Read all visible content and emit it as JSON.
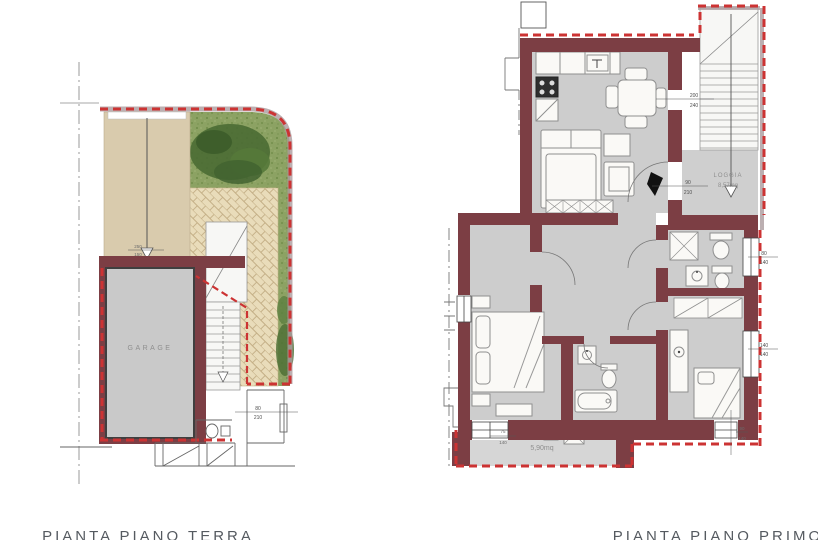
{
  "colors": {
    "wall": "#7c3e44",
    "boundary_red": "#cc3333",
    "boundary_band": "#ab9b9d",
    "floor_gray": "#cdcdcd",
    "driveway_tan": "#d9cbad",
    "grass_green": "#8ca263",
    "brick_tan": "#e9dcba",
    "title_gray": "#555a60"
  },
  "ground_floor": {
    "title": "PIANTA PIANO TERRA",
    "garage_label": "GARAGE",
    "ramp_dim_top": "250",
    "ramp_dim_bottom": "150",
    "door_dim_top": "80",
    "door_dim_bottom": "210"
  },
  "first_floor": {
    "title": "PIANTA PIANO PRIMO",
    "loggia_label": "LOGGIA",
    "loggia_area": "8,57mq",
    "terrace_area": "5,90mq",
    "entry_dim_top": "90",
    "entry_dim_bottom": "210",
    "loggia_door_dim_top": "200",
    "loggia_door_dim_bottom": "240",
    "window_right_upper_top": "80",
    "window_right_upper_bottom": "140",
    "window_right_lower_top": "140",
    "window_right_lower_bottom": "140",
    "terrace_window_top": "75",
    "terrace_window_bottom": "140",
    "bottom_window_top": "90",
    "bottom_window_bottom": "140"
  }
}
